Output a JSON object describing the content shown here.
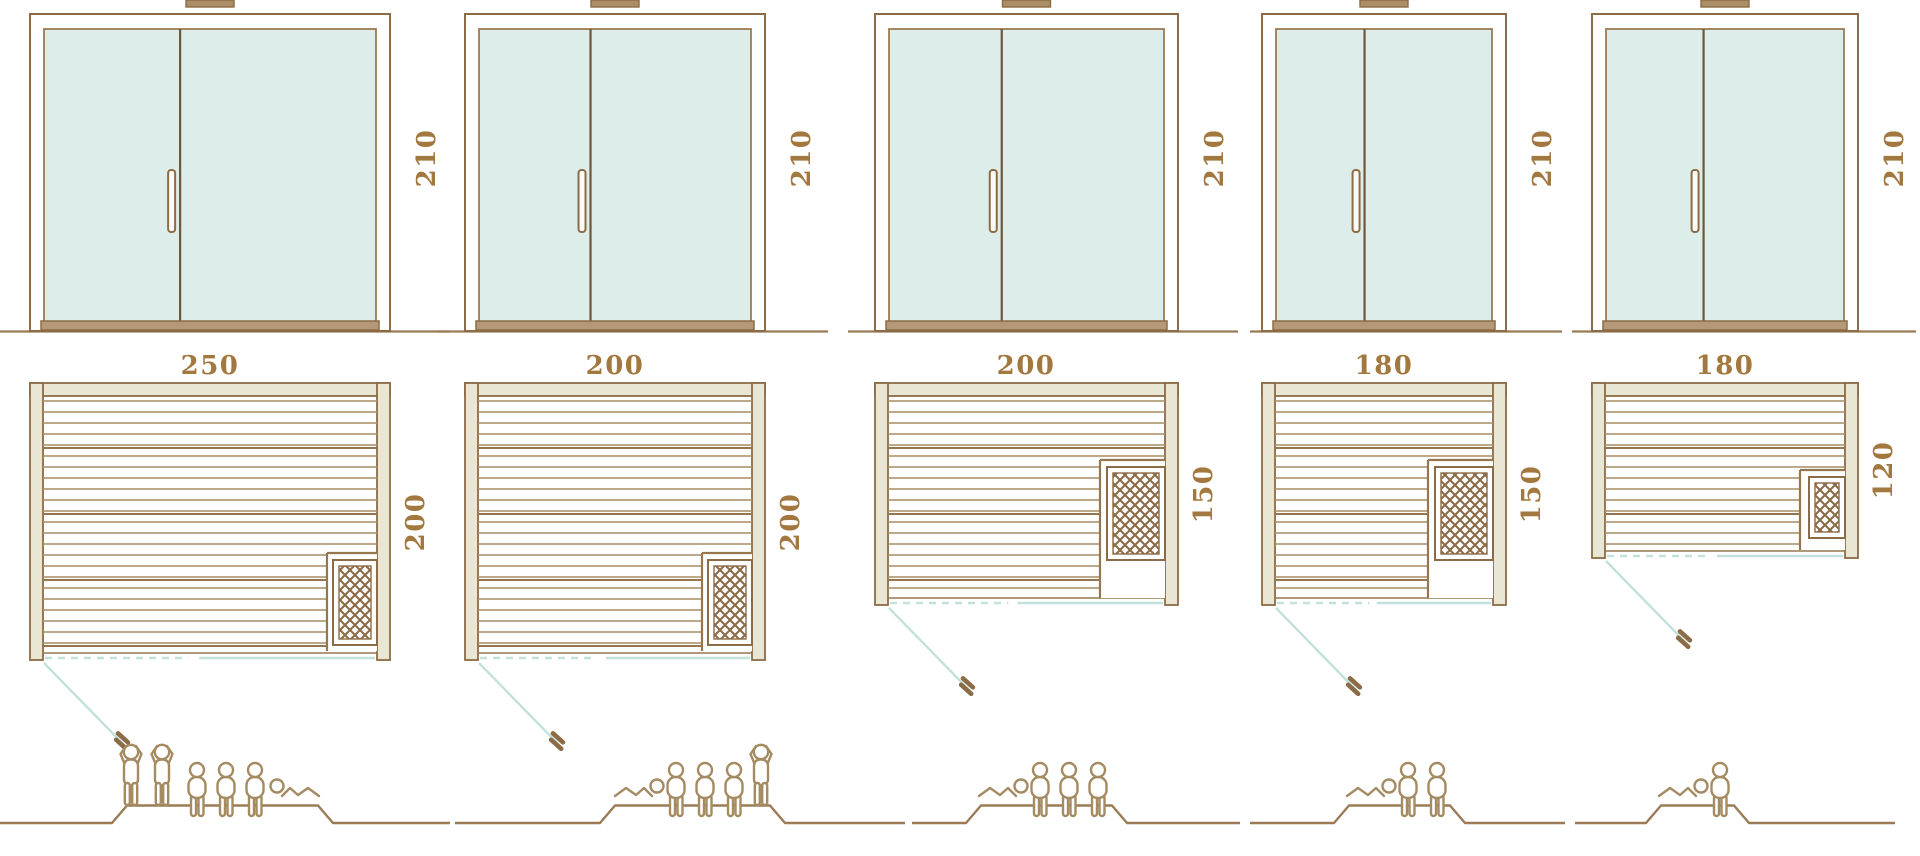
{
  "page": {
    "width": 1920,
    "height": 856,
    "background": "#ffffff",
    "description": "Technical diagram of five sauna cabin sizes: glass door front elevations (height 210), floor plans with width/depth dimensions, heater position, door swing, and capacity figures"
  },
  "palette": {
    "line_brown": "#8c6b47",
    "slat_brown": "#a98c64",
    "slat_dark": "#96764f",
    "wall_fill": "#e9e6d3",
    "glass_fill": "#ddeeea",
    "glass_line": "#9c7b52",
    "sill_fill": "#b49877",
    "teal_line": "#c2e1dc",
    "label_brown": "#a3783f",
    "figure_brown": "#a58b62",
    "ground_brown": "#9a7b55",
    "divider_brown": "#6e573b",
    "handle_fill": "#fdfbf7"
  },
  "diagram": {
    "models": [
      {
        "name": "250x200",
        "labels": {
          "plan_width": "250",
          "plan_depth": "200",
          "elevation_height": "210"
        },
        "capacity": {
          "standing": 2,
          "sitting": 3,
          "lying": 1,
          "total": 6
        },
        "figure_sequence": [
          "stand",
          "stand",
          "sit",
          "sit",
          "sit",
          "lie"
        ],
        "lying_flipped": true,
        "geom": {
          "elev": {
            "x": 30,
            "w": 360
          },
          "plan": {
            "x": 30,
            "w": 360,
            "top": 383,
            "bottom": 660
          },
          "ground": [
            0,
            450
          ],
          "heater": {
            "bay_x": 327,
            "bay_top": 553,
            "bay_bottom": 651,
            "box": {
              "x": 333,
              "y": 560,
              "w": 44,
              "h": 85
            }
          },
          "label_pos": {
            "width": [
              210,
              374
            ],
            "depth": [
              417,
              522
            ],
            "height": [
              428,
              158
            ]
          },
          "people": {
            "line": [
              0,
              450
            ],
            "platform": [
              112,
              318
            ],
            "figures": [
              [
                "stand",
                118
              ],
              [
                "stand",
                149
              ],
              [
                "sit",
                183
              ],
              [
                "sit",
                212
              ],
              [
                "sit",
                241
              ],
              [
                "lie",
                270
              ]
            ]
          }
        }
      },
      {
        "name": "200x200",
        "labels": {
          "plan_width": "200",
          "plan_depth": "200",
          "elevation_height": "210"
        },
        "capacity": {
          "standing": 1,
          "sitting": 3,
          "lying": 1,
          "total": 5
        },
        "figure_sequence": [
          "lie",
          "sit",
          "sit",
          "sit",
          "stand"
        ],
        "lying_flipped": false,
        "geom": {
          "elev": {
            "x": 465,
            "w": 300
          },
          "plan": {
            "x": 465,
            "w": 300,
            "top": 383,
            "bottom": 660
          },
          "ground": [
            437,
            828
          ],
          "heater": {
            "bay_x": 702,
            "bay_top": 553,
            "bay_bottom": 651,
            "box": {
              "x": 708,
              "y": 560,
              "w": 44,
              "h": 85
            }
          },
          "label_pos": {
            "width": [
              615,
              374
            ],
            "depth": [
              792,
              522
            ],
            "height": [
              803,
              158
            ]
          },
          "people": {
            "line": [
              455,
              905
            ],
            "platform": [
              600,
              770
            ],
            "figures": [
              [
                "lie",
                608
              ],
              [
                "sit",
                662
              ],
              [
                "sit",
                691
              ],
              [
                "sit",
                720
              ],
              [
                "stand",
                748
              ]
            ]
          }
        }
      },
      {
        "name": "200x150",
        "labels": {
          "plan_width": "200",
          "plan_depth": "150",
          "elevation_height": "210"
        },
        "capacity": {
          "standing": 0,
          "sitting": 3,
          "lying": 1,
          "total": 4
        },
        "figure_sequence": [
          "lie",
          "sit",
          "sit",
          "sit"
        ],
        "lying_flipped": false,
        "geom": {
          "elev": {
            "x": 875,
            "w": 303
          },
          "plan": {
            "x": 875,
            "w": 303,
            "top": 383,
            "bottom": 605
          },
          "ground": [
            848,
            1238
          ],
          "heater": {
            "bay_x": 1100,
            "bay_top": 460,
            "bay_bottom": 598,
            "box": {
              "x": 1107,
              "y": 467,
              "w": 58,
              "h": 93
            }
          },
          "label_pos": {
            "width": [
              1026,
              374
            ],
            "depth": [
              1205,
              494
            ],
            "height": [
              1216,
              158
            ]
          },
          "people": {
            "line": [
              912,
              1240
            ],
            "platform": [
              966,
              1112
            ],
            "figures": [
              [
                "lie",
                972
              ],
              [
                "sit",
                1026
              ],
              [
                "sit",
                1055
              ],
              [
                "sit",
                1084
              ]
            ]
          }
        }
      },
      {
        "name": "180x150",
        "labels": {
          "plan_width": "180",
          "plan_depth": "150",
          "elevation_height": "210"
        },
        "capacity": {
          "standing": 0,
          "sitting": 2,
          "lying": 1,
          "total": 3
        },
        "figure_sequence": [
          "lie",
          "sit",
          "sit"
        ],
        "lying_flipped": false,
        "geom": {
          "elev": {
            "x": 1262,
            "w": 244
          },
          "plan": {
            "x": 1262,
            "w": 244,
            "top": 383,
            "bottom": 605
          },
          "ground": [
            1250,
            1562
          ],
          "heater": {
            "bay_x": 1428,
            "bay_top": 460,
            "bay_bottom": 598,
            "box": {
              "x": 1435,
              "y": 467,
              "w": 58,
              "h": 93
            }
          },
          "label_pos": {
            "width": [
              1384,
              374
            ],
            "depth": [
              1533,
              494
            ],
            "height": [
              1544,
              158
            ]
          },
          "people": {
            "line": [
              1250,
              1565
            ],
            "platform": [
              1334,
              1450
            ],
            "figures": [
              [
                "lie",
                1340
              ],
              [
                "sit",
                1394
              ],
              [
                "sit",
                1423
              ]
            ]
          }
        }
      },
      {
        "name": "180x120",
        "labels": {
          "plan_width": "180",
          "plan_depth": "120",
          "elevation_height": "210"
        },
        "capacity": {
          "standing": 0,
          "sitting": 1,
          "lying": 1,
          "total": 2
        },
        "figure_sequence": [
          "lie",
          "sit"
        ],
        "lying_flipped": false,
        "geom": {
          "elev": {
            "x": 1592,
            "w": 266
          },
          "plan": {
            "x": 1592,
            "w": 266,
            "top": 383,
            "bottom": 558
          },
          "ground": [
            1572,
            1916
          ],
          "heater": {
            "bay_x": 1800,
            "bay_top": 470,
            "bay_bottom": 550,
            "box": {
              "x": 1809,
              "y": 477,
              "w": 36,
              "h": 61
            }
          },
          "label_pos": {
            "width": [
              1725,
              374
            ],
            "depth": [
              1885,
              470
            ],
            "height": [
              1896,
              158
            ]
          },
          "people": {
            "line": [
              1575,
              1895
            ],
            "platform": [
              1646,
              1734
            ],
            "figures": [
              [
                "lie",
                1652
              ],
              [
                "sit",
                1706
              ]
            ]
          }
        }
      }
    ]
  }
}
